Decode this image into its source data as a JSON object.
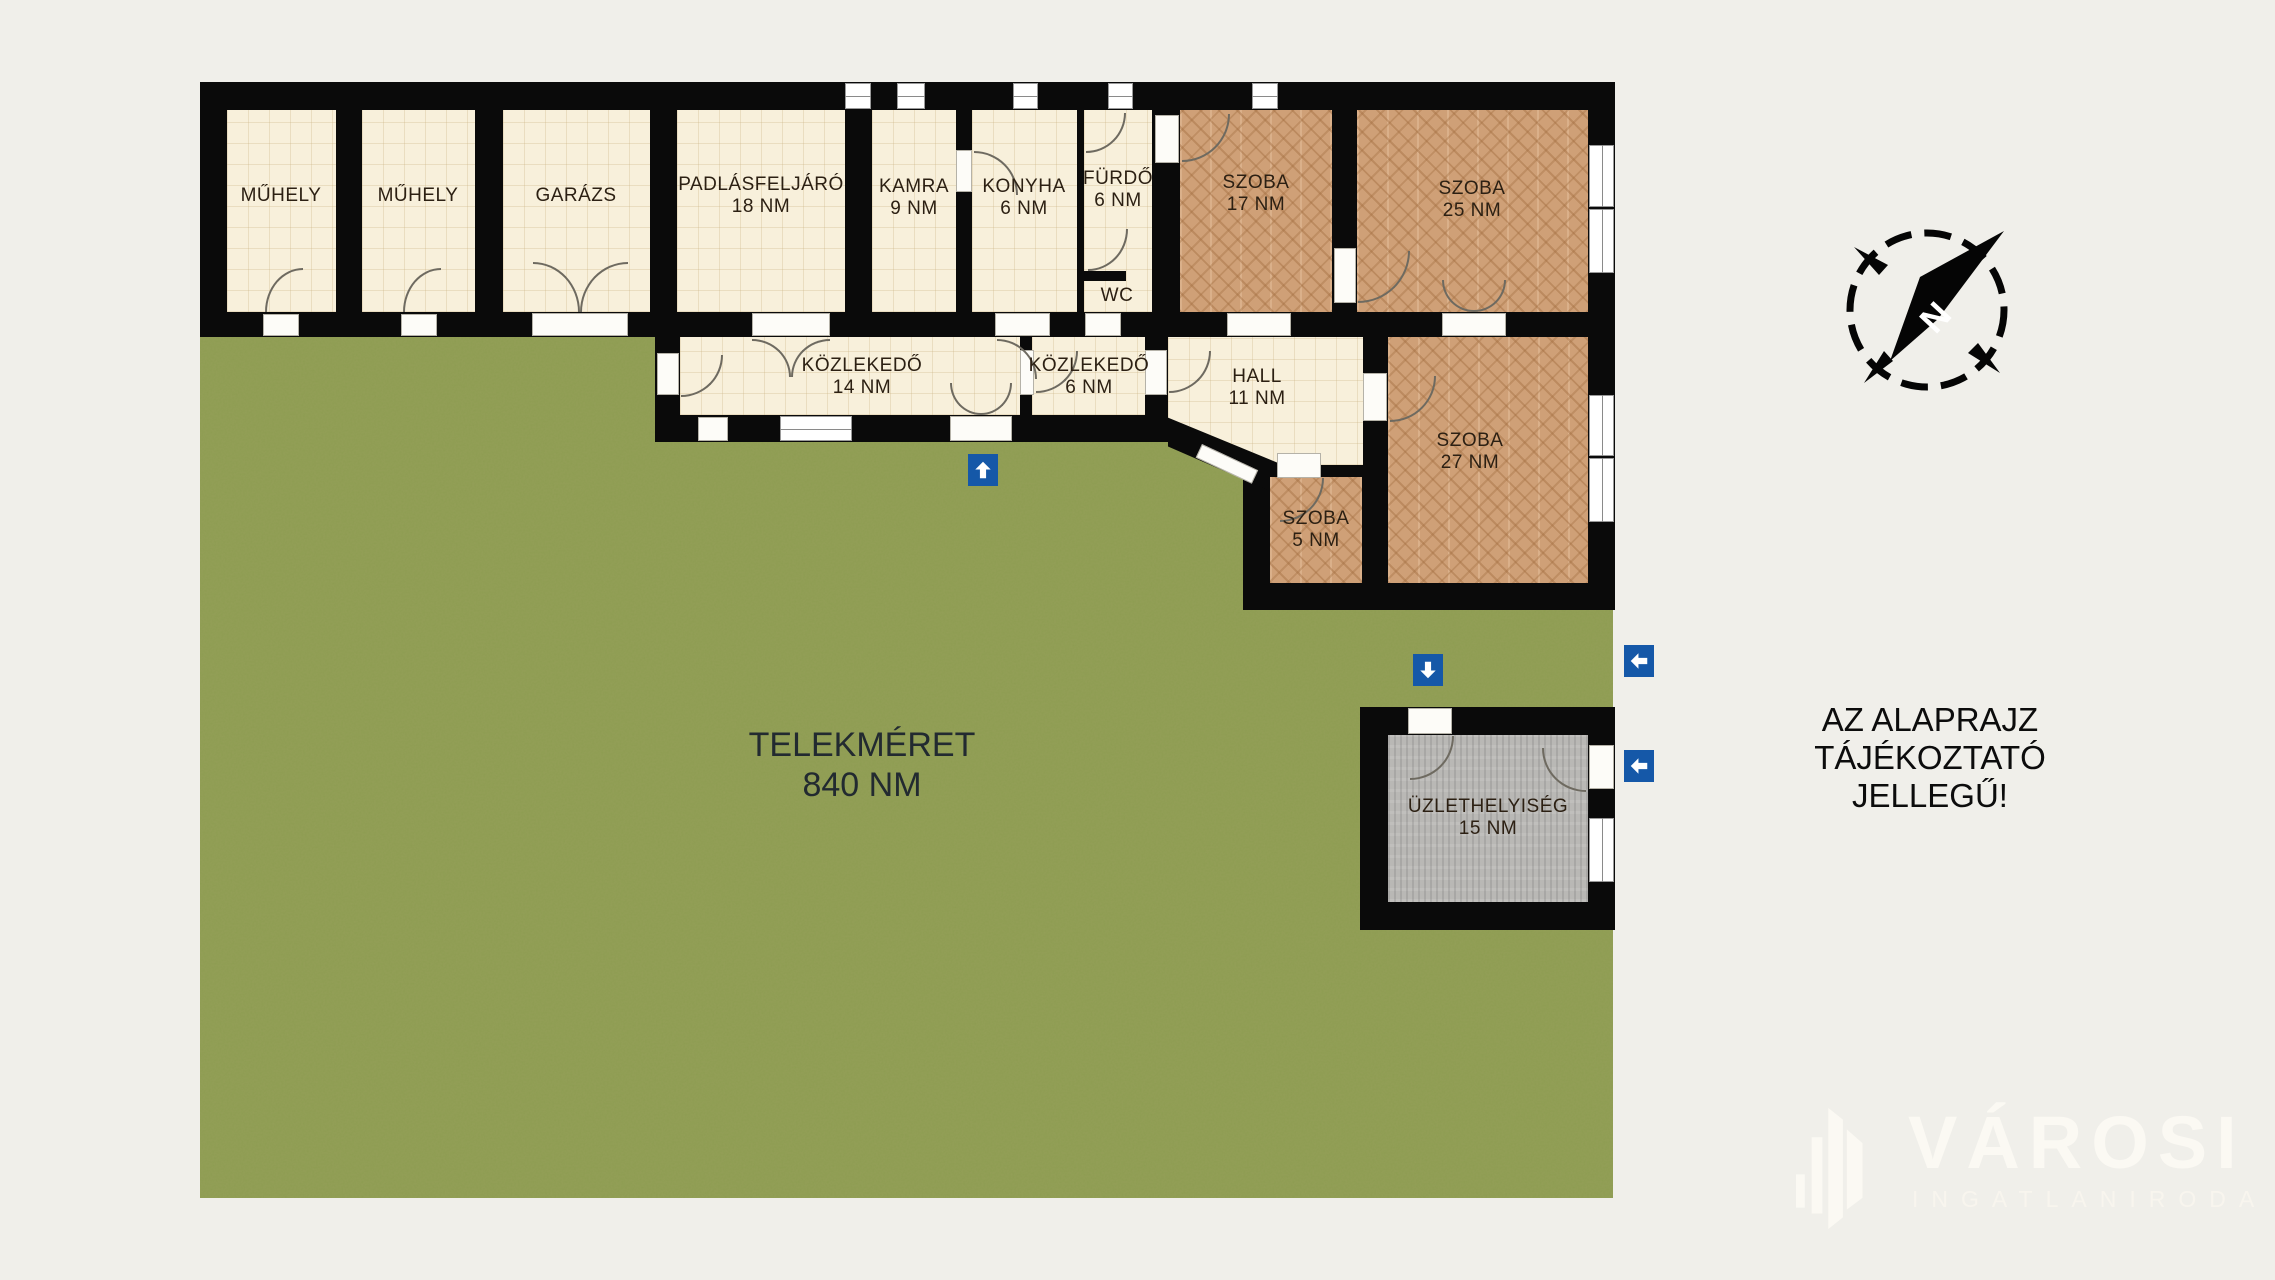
{
  "colors": {
    "background": "#f0efea",
    "wall": "#0a0a0a",
    "floor_cream": "#f8f0db",
    "floor_parquet": "#cfa077",
    "floor_shop_gray": "#b9b8b5",
    "grass_green": "#8d9c51",
    "arrow_blue": "#1558a8",
    "label_dark": "#2c2013"
  },
  "plan": {
    "rooms": [
      {
        "id": "muhely-1",
        "label": "MŰHELY",
        "area": "",
        "floor": "cream"
      },
      {
        "id": "muhely-2",
        "label": "MŰHELY",
        "area": "",
        "floor": "cream"
      },
      {
        "id": "garazs",
        "label": "GARÁZS",
        "area": "",
        "floor": "cream"
      },
      {
        "id": "padlasfeljaro",
        "label": "PADLÁSFELJÁRÓ",
        "area": "18 NM",
        "floor": "cream"
      },
      {
        "id": "kamra",
        "label": "KAMRA",
        "area": "9 NM",
        "floor": "cream"
      },
      {
        "id": "konyha",
        "label": "KONYHA",
        "area": "6 NM",
        "floor": "cream"
      },
      {
        "id": "furdo",
        "label": "FÜRDŐ",
        "area": "6 NM",
        "floor": "cream"
      },
      {
        "id": "wc",
        "label": "WC",
        "area": "",
        "floor": "cream"
      },
      {
        "id": "szoba-17",
        "label": "SZOBA",
        "area": "17 NM",
        "floor": "parquet"
      },
      {
        "id": "szoba-25",
        "label": "SZOBA",
        "area": "25 NM",
        "floor": "parquet"
      },
      {
        "id": "kozlekedo-14",
        "label": "KÖZLEKEDŐ",
        "area": "14 NM",
        "floor": "cream"
      },
      {
        "id": "kozlekedo-6",
        "label": "KÖZLEKEDŐ",
        "area": "6 NM",
        "floor": "cream"
      },
      {
        "id": "hall",
        "label": "HALL",
        "area": "11 NM",
        "floor": "cream"
      },
      {
        "id": "szoba-27",
        "label": "SZOBA",
        "area": "27 NM",
        "floor": "parquet"
      },
      {
        "id": "szoba-5",
        "label": "SZOBA",
        "area": "5 NM",
        "floor": "parquet"
      },
      {
        "id": "uzlethelyiseg",
        "label": "ÜZLETHELYISÉG",
        "area": "15 NM",
        "floor": "gray"
      }
    ],
    "garden": {
      "label": "TELEKMÉRET",
      "area": "840 NM"
    }
  },
  "disclaimer": {
    "text": "AZ ALAPRAJZ TÁJÉKOZTATÓ JELLEGŰ!"
  },
  "compass": {
    "north": "N"
  },
  "logo": {
    "brand": "VÁROSI",
    "subtitle": "INGATLANIRODA"
  },
  "icons": {
    "compass": "compass-rose-icon",
    "entrance_arrows": [
      "arrow-up-icon",
      "arrow-down-icon",
      "arrow-left-icon",
      "arrow-left-icon"
    ]
  }
}
